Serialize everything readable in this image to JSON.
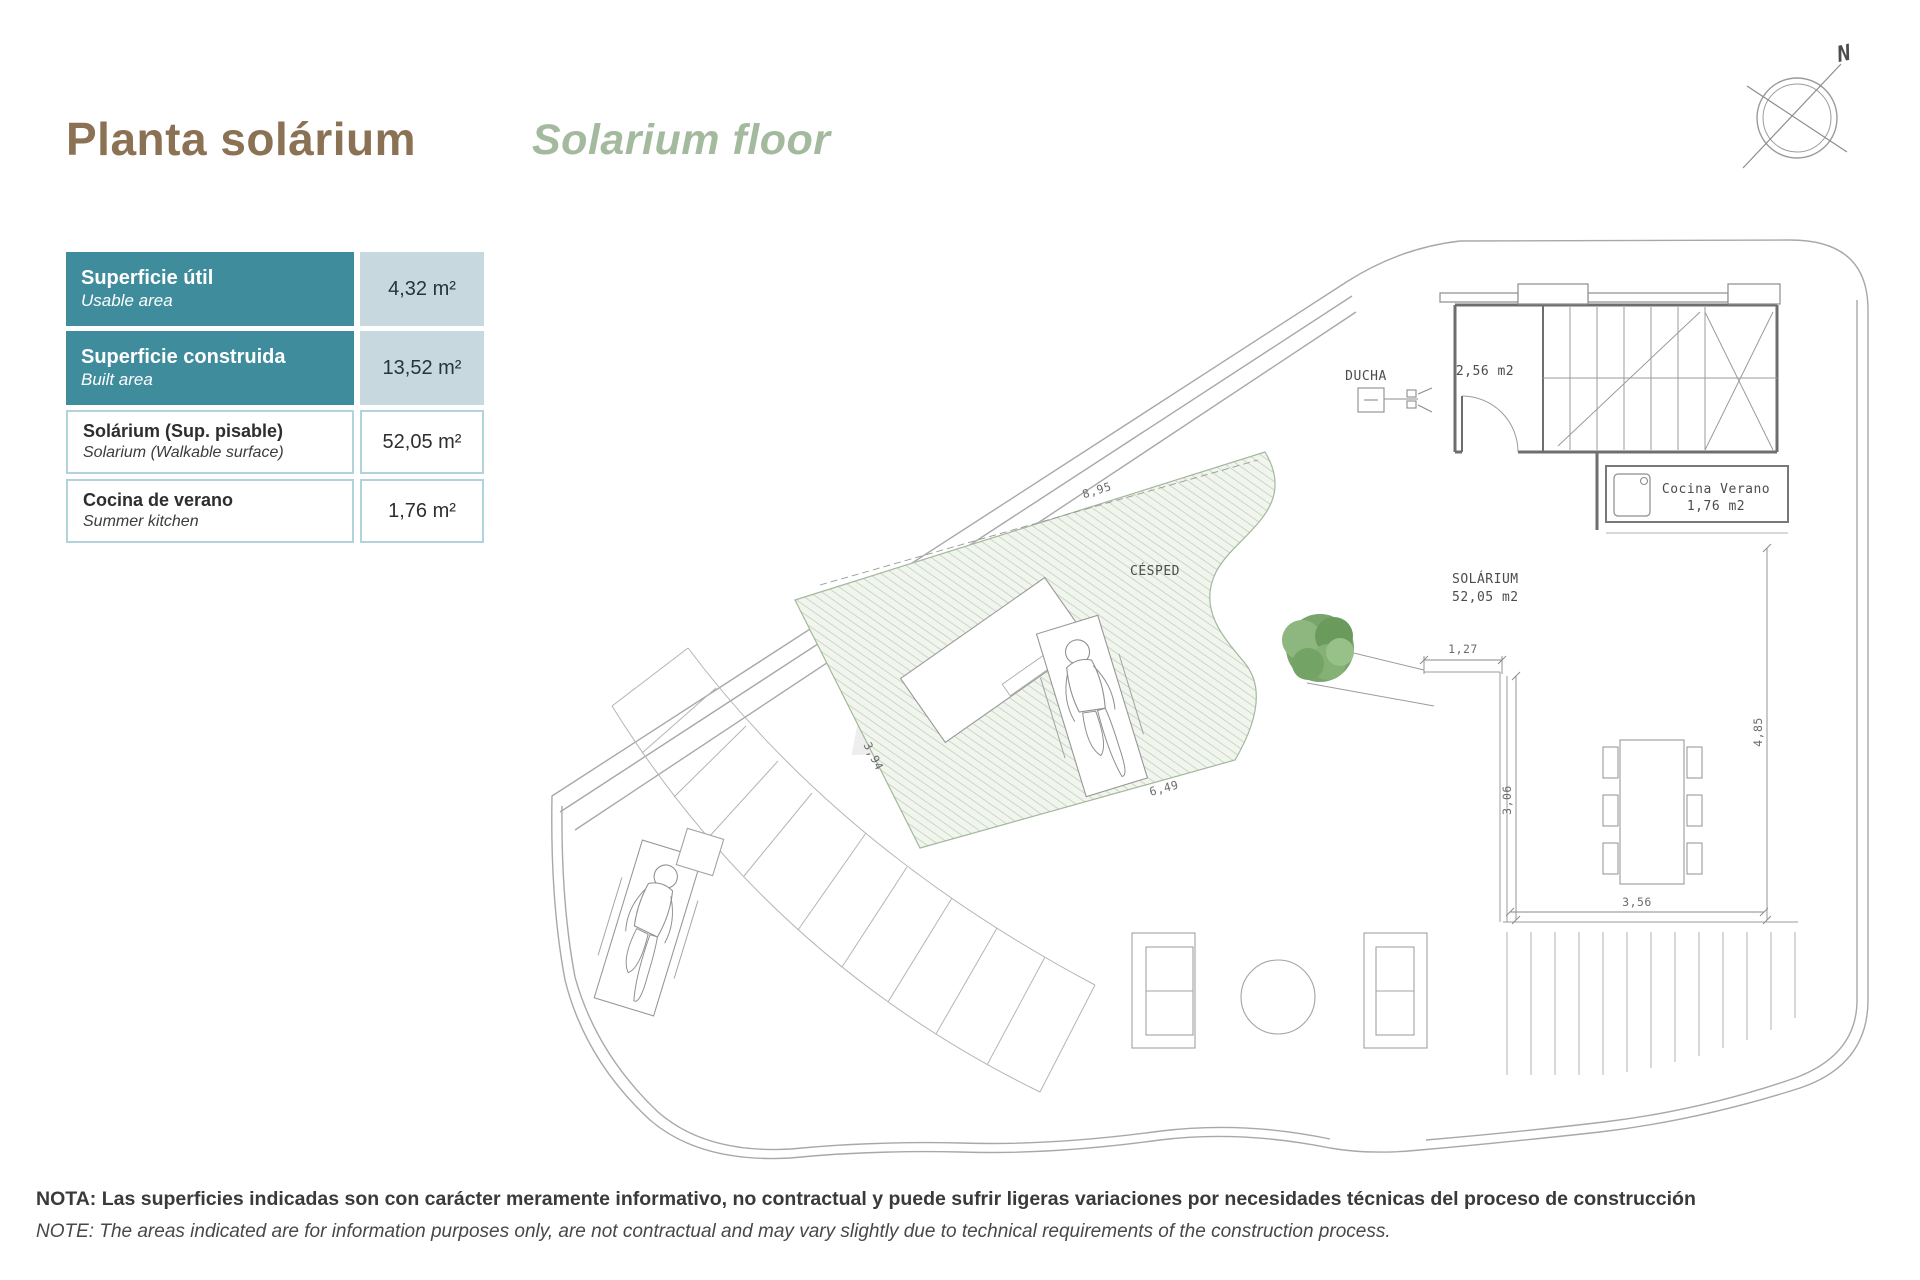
{
  "page": {
    "title_es": "Planta solárium",
    "title_en": "Solarium floor",
    "note_es": "NOTA: Las superficies indicadas son con carácter meramente informativo, no contractual y puede sufrir ligeras variaciones por necesidades técnicas del proceso de construcción",
    "note_en": "NOTE: The areas indicated are for information purposes only, are not contractual and may vary slightly due to technical requirements of the construction process.",
    "compass_label": "N"
  },
  "colors": {
    "title_brown": "#8b7254",
    "title_green": "#a4ba9e",
    "teal_header": "#3f8c9c",
    "value_bg": "#c7d9de",
    "cell_border": "#b2d3dc",
    "grass_hatch": "#bdd3b8",
    "plan_line": "#9b9b9b"
  },
  "area_table": {
    "rows": [
      {
        "label_es": "Superficie útil",
        "label_en": "Usable area",
        "value": "4,32 m²"
      },
      {
        "label_es": "Superficie construida",
        "label_en": "Built area",
        "value": "13,52 m²"
      },
      {
        "label_es": "Solárium (Sup. pisable)",
        "label_en": "Solarium (Walkable surface)",
        "value": "52,05 m²"
      },
      {
        "label_es": "Cocina de verano",
        "label_en": "Summer kitchen",
        "value": "1,76 m²"
      }
    ]
  },
  "plan": {
    "labels": {
      "ducha": "DUCHA",
      "stair_room_area": "2,56 m2",
      "summer_kitchen_1": "Cocina Verano",
      "summer_kitchen_2": "1,76 m2",
      "grass": "CÉSPED",
      "solarium_1": "SOLÁRIUM",
      "solarium_2": "52,05 m2"
    },
    "dimensions": {
      "top_edge": "8,95",
      "left_edge": "3,94",
      "bottom_edge": "6,49",
      "deck_width": "1,27",
      "deck_height": "3,06",
      "right_height": "4,85",
      "deck_bottom": "3,56"
    }
  }
}
